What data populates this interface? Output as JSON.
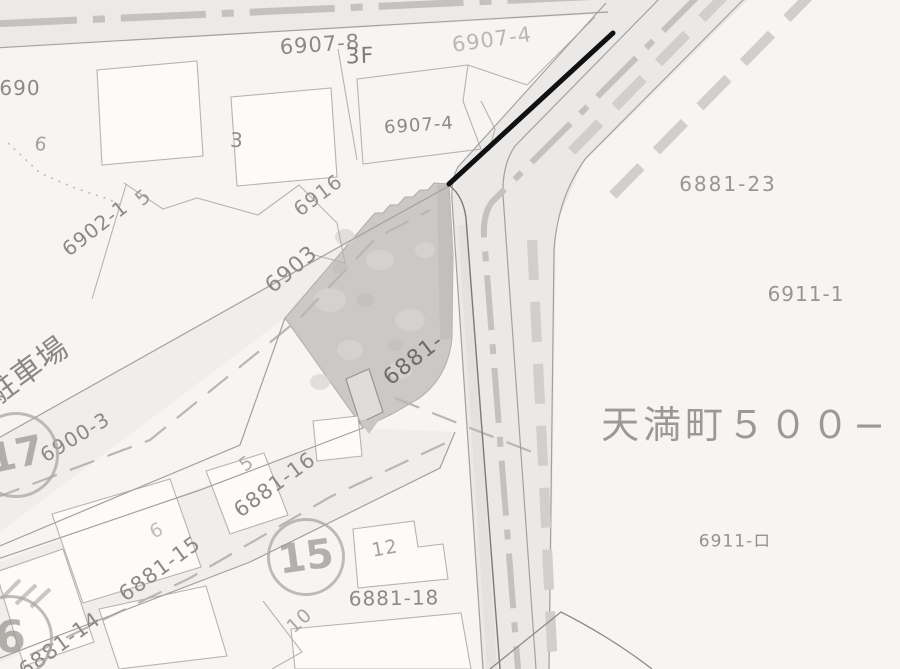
{
  "area": {
    "district_label": "天満町５００−",
    "parking_label": "駐車場"
  },
  "parcels": {
    "p6907_8": "6907-8",
    "p6907_4_upper": "6907-4",
    "p6907_4_lower": "6907-4",
    "p690_partial": "690",
    "p6902_1": "6902-1",
    "p6903": "6903",
    "p6916": "6916",
    "p6900_3": "6900-3",
    "p6881_shaded": "6881-",
    "p6881_14": "6881-14",
    "p6881_15": "6881-15",
    "p6881_16": "6881-16",
    "p6881_18": "6881-18",
    "p6881_23": "6881-23",
    "p6911_1": "6911-1",
    "p6911_ro": "6911-ロ"
  },
  "building_numbers": {
    "b3f": "3F",
    "b3": "3",
    "b5_top": "5",
    "b5_mid": "5",
    "b6_top": "6",
    "b6_mid": "6",
    "b10": "10",
    "b12": "12"
  },
  "survey_points": {
    "c17": "17",
    "c15": "15",
    "c6": "6"
  },
  "colors": {
    "paper": "#f6f5f3",
    "road_fill": "#edecea",
    "line_gray": "#a6a4a2",
    "label_gray": "#8c8a88",
    "shaded_parcel": "#cbc9c7",
    "boundary_marker_black": "#111111",
    "chain_line_gray": "#c3c2c0"
  }
}
